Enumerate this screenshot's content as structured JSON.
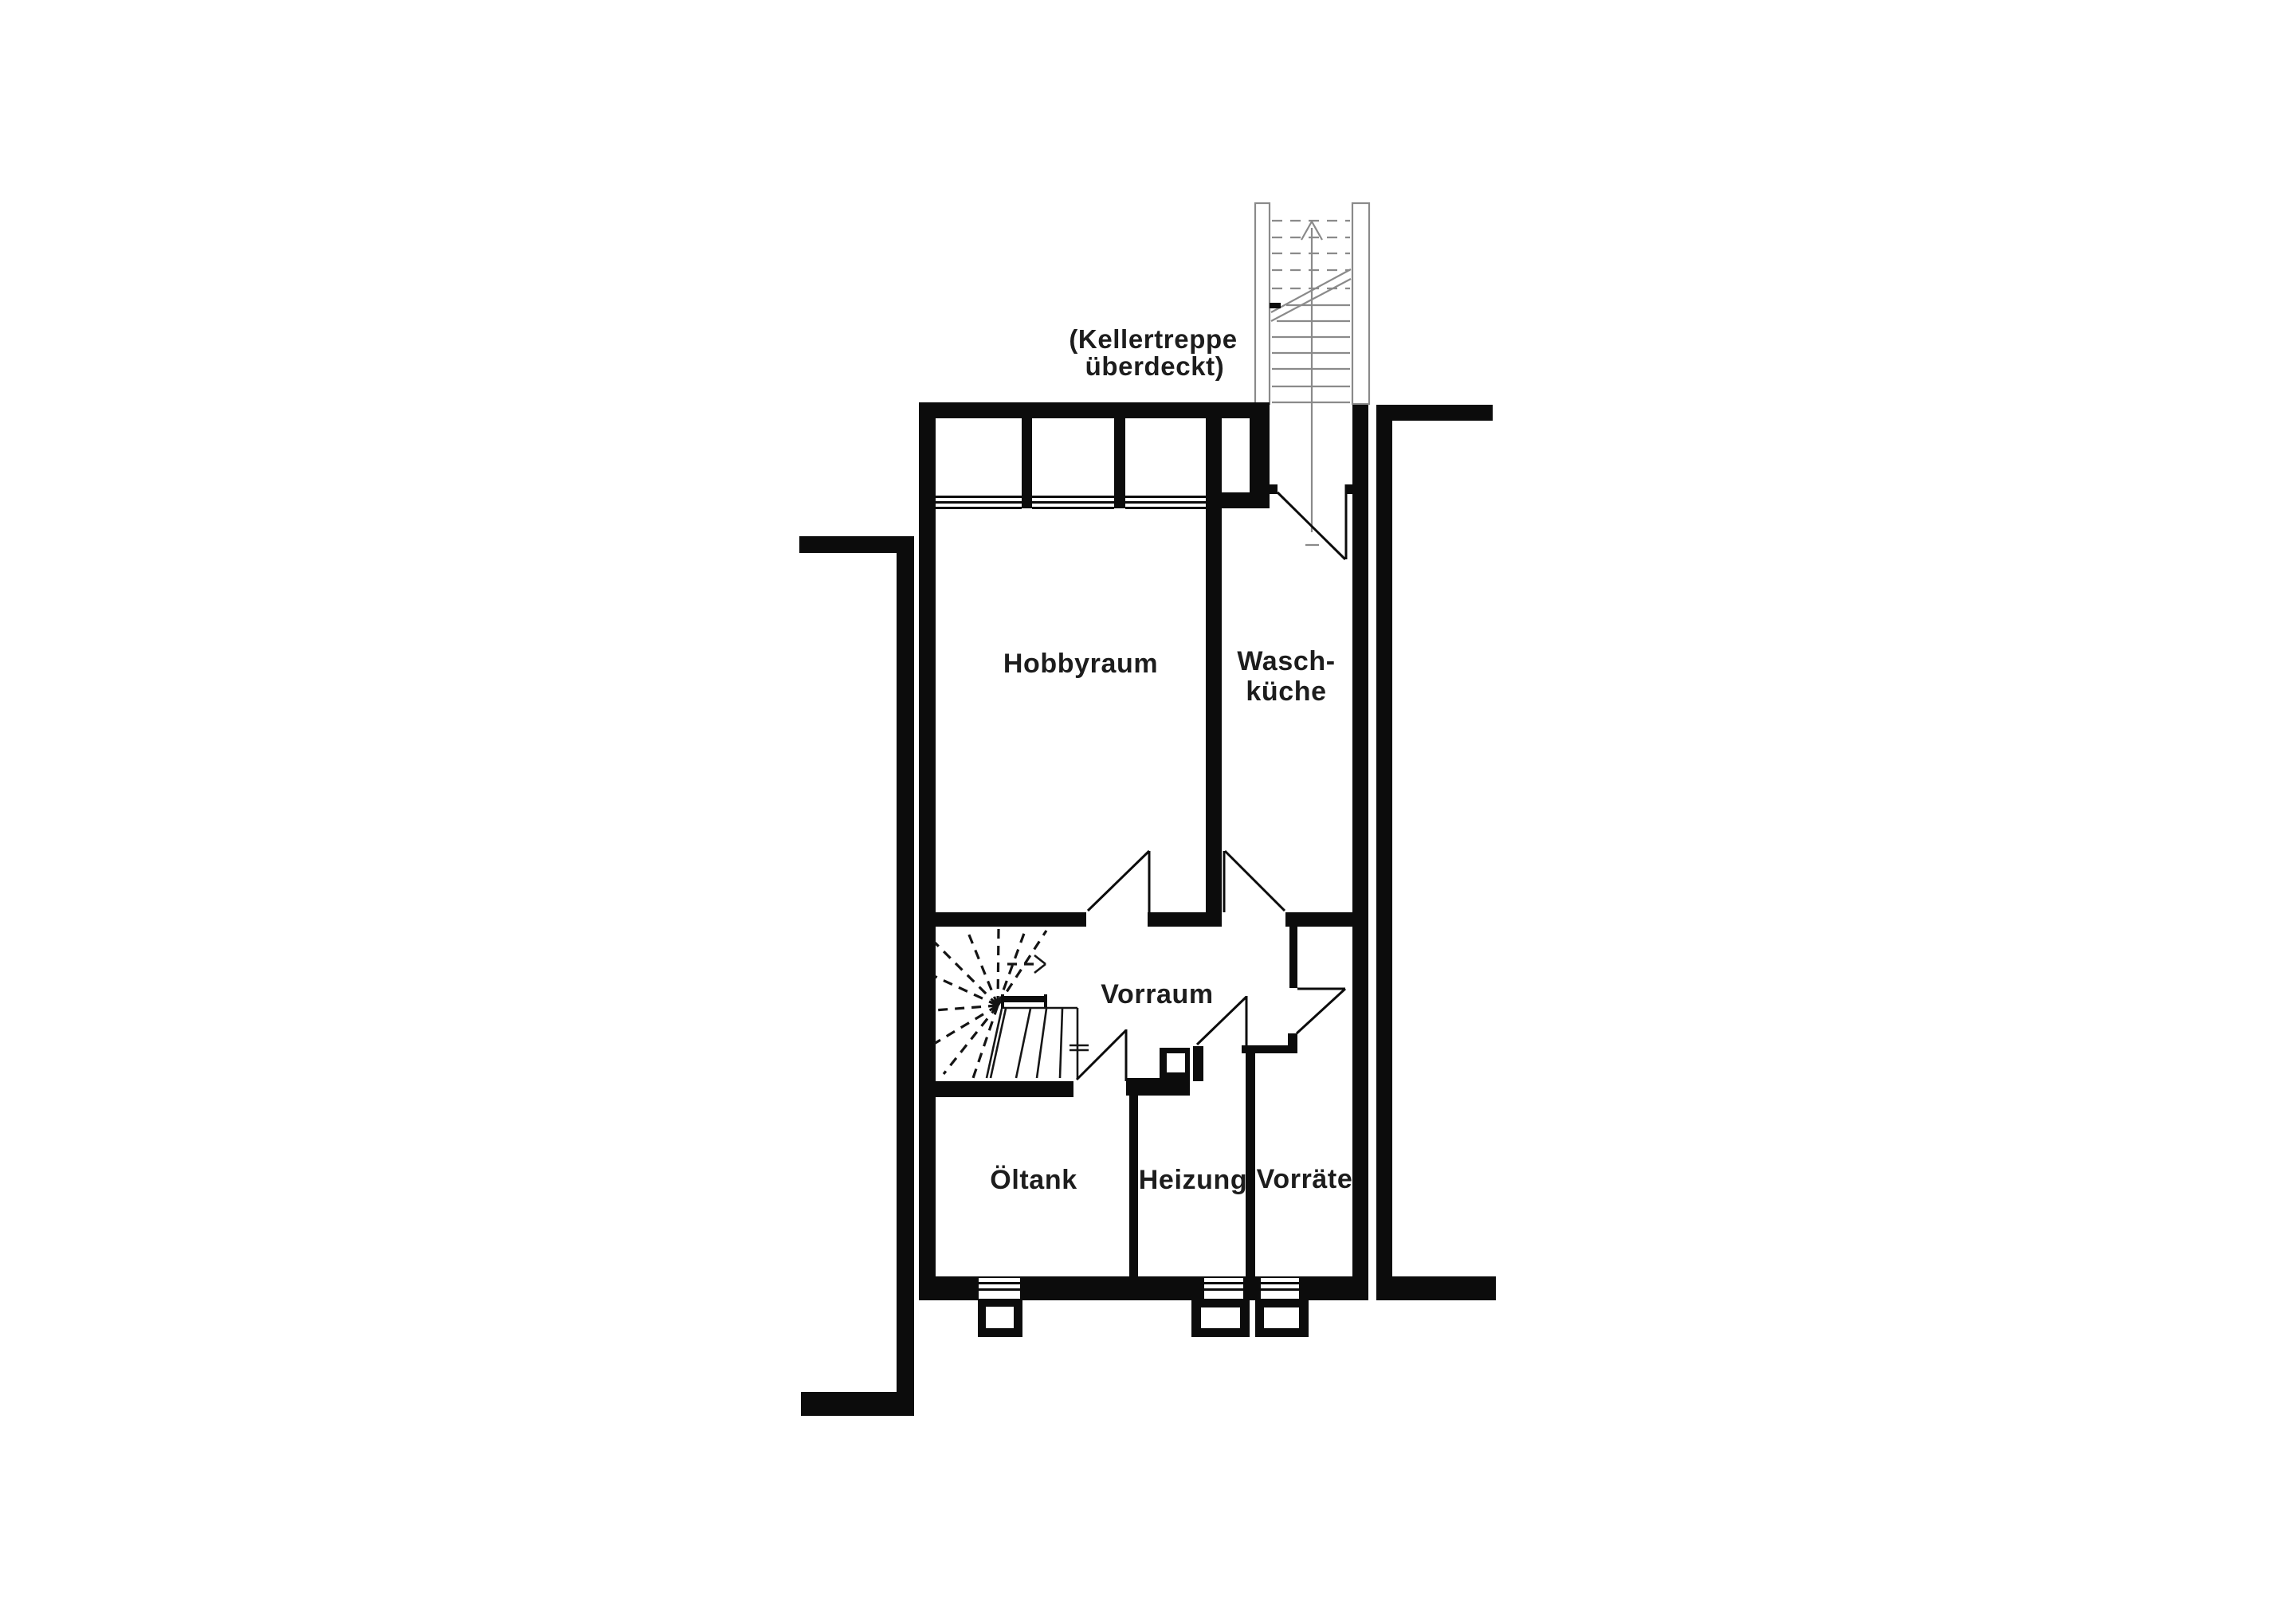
{
  "figure": {
    "type": "floor-plan",
    "level": "basement"
  },
  "colors": {
    "background": "#ffffff",
    "wall": "#0c0c0c",
    "stair_outline": "#8a8a8a",
    "label_text": "#1d1d1d"
  },
  "annotation": {
    "line1": "(Kellertreppe",
    "line2": "überdeckt)"
  },
  "labels": {
    "hobbyraum": "Hobbyraum",
    "waschkueche_line1": "Wasch-",
    "waschkueche_line2": "küche",
    "vorraum": "Vorraum",
    "oeltank": "Öltank",
    "heizung": "Heizung",
    "vorraete": "Vorräte"
  }
}
